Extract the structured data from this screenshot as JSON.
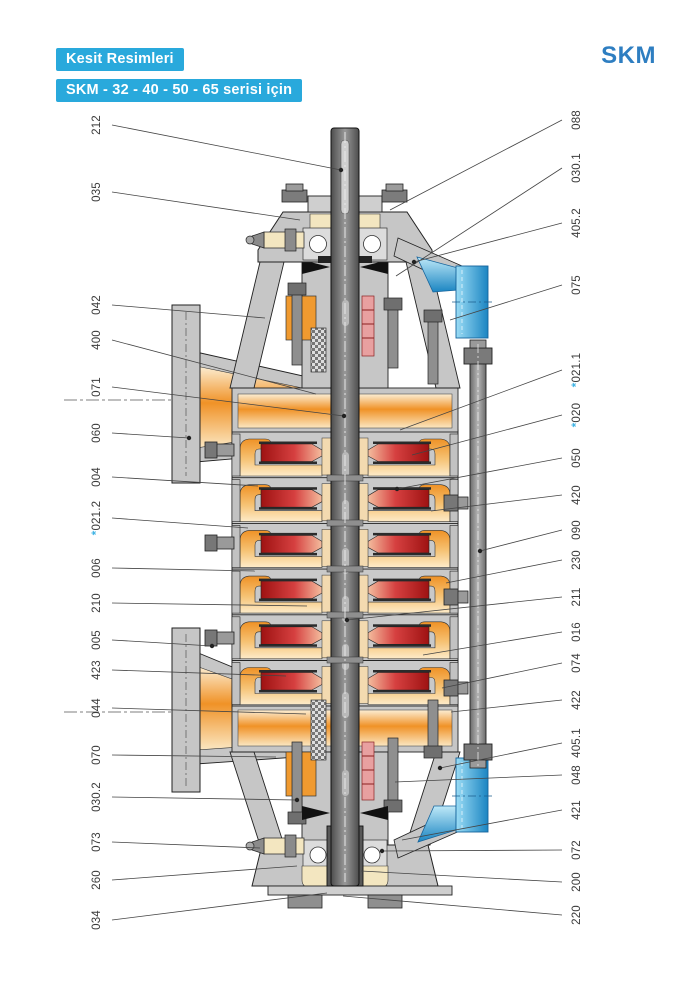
{
  "header": {
    "badge1": "Kesit Resimleri",
    "badge2": "SKM - 32 - 40 - 50 - 65 serisi için",
    "logo": "SKM",
    "accent_color": "#29a9dc",
    "logo_color": "#2e7ec1"
  },
  "diagram": {
    "description": "Sectional drawing (kesit resmi) of SKM 32-40-50-65 series vertical multistage pump",
    "colors": {
      "casting_gray": "#c6c6c6",
      "shaft_gray": "#6e6e6e",
      "flow_orange": "#f09227",
      "impeller_red": "#b81f1f",
      "flange_blue": "#2e9fd4",
      "bearing_cream": "#f3e6c0",
      "star_blue": "#3fb3e4"
    },
    "labels_left": [
      {
        "no": "212",
        "y": 125,
        "tx": 341,
        "ty": 170,
        "dot": true
      },
      {
        "no": "035",
        "y": 192,
        "tx": 300,
        "ty": 220,
        "dot": false
      },
      {
        "no": "042",
        "y": 305,
        "tx": 265,
        "ty": 318,
        "dot": false
      },
      {
        "no": "400",
        "y": 340,
        "tx": 316,
        "ty": 394,
        "dot": false
      },
      {
        "no": "071",
        "y": 387,
        "tx": 344,
        "ty": 416,
        "dot": true
      },
      {
        "no": "060",
        "y": 433,
        "tx": 189,
        "ty": 438,
        "dot": true
      },
      {
        "no": "004",
        "y": 477,
        "tx": 258,
        "ty": 486,
        "dot": false
      },
      {
        "no": "*021.2",
        "y": 518,
        "tx": 248,
        "ty": 528,
        "dot": false
      },
      {
        "no": "006",
        "y": 568,
        "tx": 255,
        "ty": 571,
        "dot": false
      },
      {
        "no": "210",
        "y": 603,
        "tx": 307,
        "ty": 606,
        "dot": false
      },
      {
        "no": "005",
        "y": 640,
        "tx": 212,
        "ty": 646,
        "dot": true
      },
      {
        "no": "423",
        "y": 670,
        "tx": 286,
        "ty": 676,
        "dot": false
      },
      {
        "no": "044",
        "y": 708,
        "tx": 306,
        "ty": 714,
        "dot": false
      },
      {
        "no": "070",
        "y": 755,
        "tx": 276,
        "ty": 757,
        "dot": false
      },
      {
        "no": "030.2",
        "y": 797,
        "tx": 297,
        "ty": 800,
        "dot": true
      },
      {
        "no": "073",
        "y": 842,
        "tx": 260,
        "ty": 848,
        "dot": false
      },
      {
        "no": "260",
        "y": 880,
        "tx": 297,
        "ty": 866,
        "dot": false
      },
      {
        "no": "034",
        "y": 920,
        "tx": 327,
        "ty": 893,
        "dot": false
      }
    ],
    "labels_right": [
      {
        "no": "088",
        "y": 120,
        "tx": 390,
        "ty": 210,
        "dot": false
      },
      {
        "no": "030.1",
        "y": 168,
        "tx": 396,
        "ty": 276,
        "dot": false
      },
      {
        "no": "405.2",
        "y": 223,
        "tx": 414,
        "ty": 262,
        "dot": true
      },
      {
        "no": "075",
        "y": 285,
        "tx": 450,
        "ty": 320,
        "dot": false
      },
      {
        "no": "*021.1",
        "y": 370,
        "tx": 400,
        "ty": 430,
        "dot": false
      },
      {
        "no": "*020",
        "y": 415,
        "tx": 412,
        "ty": 455,
        "dot": false
      },
      {
        "no": "050",
        "y": 458,
        "tx": 397,
        "ty": 489,
        "dot": true
      },
      {
        "no": "420",
        "y": 495,
        "tx": 431,
        "ty": 511,
        "dot": false
      },
      {
        "no": "090",
        "y": 530,
        "tx": 480,
        "ty": 551,
        "dot": true
      },
      {
        "no": "230",
        "y": 560,
        "tx": 446,
        "ty": 583,
        "dot": false
      },
      {
        "no": "211",
        "y": 597,
        "tx": 347,
        "ty": 620,
        "dot": true
      },
      {
        "no": "016",
        "y": 632,
        "tx": 423,
        "ty": 655,
        "dot": false
      },
      {
        "no": "074",
        "y": 663,
        "tx": 442,
        "ty": 688,
        "dot": false
      },
      {
        "no": "422",
        "y": 700,
        "tx": 451,
        "ty": 712,
        "dot": false
      },
      {
        "no": "405.1",
        "y": 743,
        "tx": 440,
        "ty": 768,
        "dot": true
      },
      {
        "no": "048",
        "y": 775,
        "tx": 395,
        "ty": 782,
        "dot": false
      },
      {
        "no": "421",
        "y": 810,
        "tx": 402,
        "ty": 840,
        "dot": false
      },
      {
        "no": "072",
        "y": 850,
        "tx": 382,
        "ty": 851,
        "dot": true
      },
      {
        "no": "200",
        "y": 882,
        "tx": 361,
        "ty": 871,
        "dot": false
      },
      {
        "no": "220",
        "y": 915,
        "tx": 343,
        "ty": 896,
        "dot": false
      }
    ]
  }
}
